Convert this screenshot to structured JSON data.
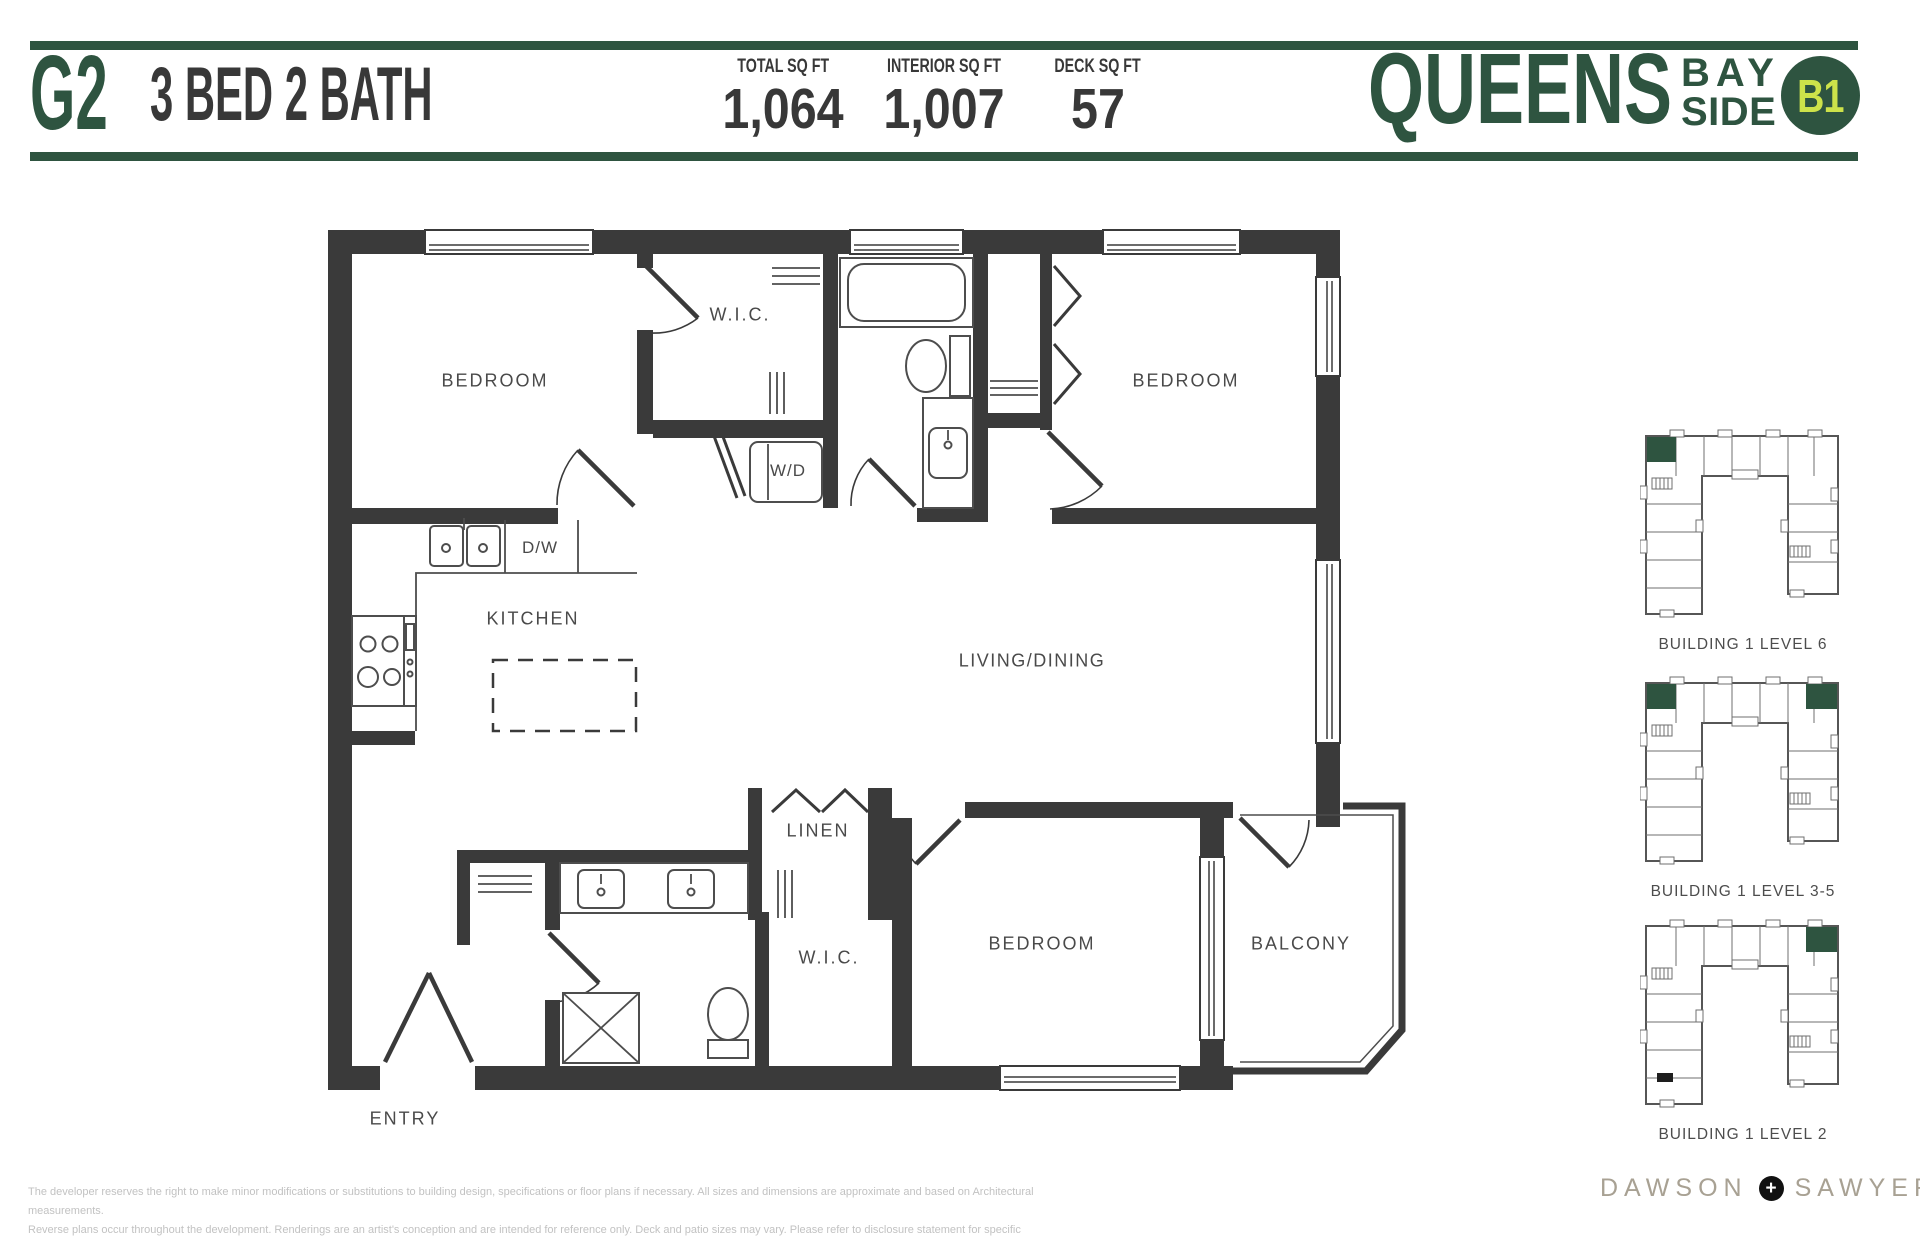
{
  "header": {
    "plan_code": "G2",
    "plan_type": "3 BED 2 BATH",
    "stats": [
      {
        "label": "TOTAL SQ FT",
        "value": "1,064"
      },
      {
        "label": "INTERIOR SQ FT",
        "value": "1,007"
      },
      {
        "label": "DECK SQ FT",
        "value": "57"
      }
    ],
    "brand": {
      "name": "QUEENS",
      "sub_line1": "BAY",
      "sub_line2": "SIDE",
      "badge": "B1"
    }
  },
  "floor_plan": {
    "rooms": [
      {
        "id": "bedroom-1",
        "label": "BEDROOM"
      },
      {
        "id": "wic-1",
        "label": "W.I.C."
      },
      {
        "id": "washer-dryer",
        "label": "W/D"
      },
      {
        "id": "dishwasher",
        "label": "D/W"
      },
      {
        "id": "kitchen",
        "label": "KITCHEN"
      },
      {
        "id": "bedroom-2",
        "label": "BEDROOM"
      },
      {
        "id": "living-dining",
        "label": "LIVING/DINING"
      },
      {
        "id": "linen",
        "label": "LINEN"
      },
      {
        "id": "wic-2",
        "label": "W.I.C."
      },
      {
        "id": "bedroom-3",
        "label": "BEDROOM"
      },
      {
        "id": "balcony",
        "label": "BALCONY"
      },
      {
        "id": "entry",
        "label": "ENTRY"
      }
    ]
  },
  "keyplates": [
    {
      "caption": "BUILDING 1 LEVEL 6",
      "markers": [
        "top-left"
      ]
    },
    {
      "caption": "BUILDING 1 LEVEL 3-5",
      "markers": [
        "top-left",
        "top-right"
      ]
    },
    {
      "caption": "BUILDING 1 LEVEL 2",
      "markers": [
        "top-right",
        "service"
      ]
    }
  ],
  "footer": {
    "disclaimer_line1": "The developer reserves the right to make minor modifications or substitutions to building design, specifications or floor plans if necessary. All sizes and dimensions are approximate and based on Architectural measurements.",
    "disclaimer_line2": "Reverse plans occur throughout the development. Renderings are an artist's conception and are intended for reference only. Deck and patio sizes may vary. Please refer to disclosure statement for specific offering details. E.&O.E.",
    "developer": {
      "name_left": "DAWSON",
      "plus": "+",
      "name_right": "SAWYER"
    }
  },
  "colors": {
    "green": "#2e5440",
    "lime": "#cde24a",
    "wall": "#3a3a3a",
    "label": "#4a4a4a",
    "taupe": "#a8a193",
    "disclaimer": "#c2c2c2"
  }
}
